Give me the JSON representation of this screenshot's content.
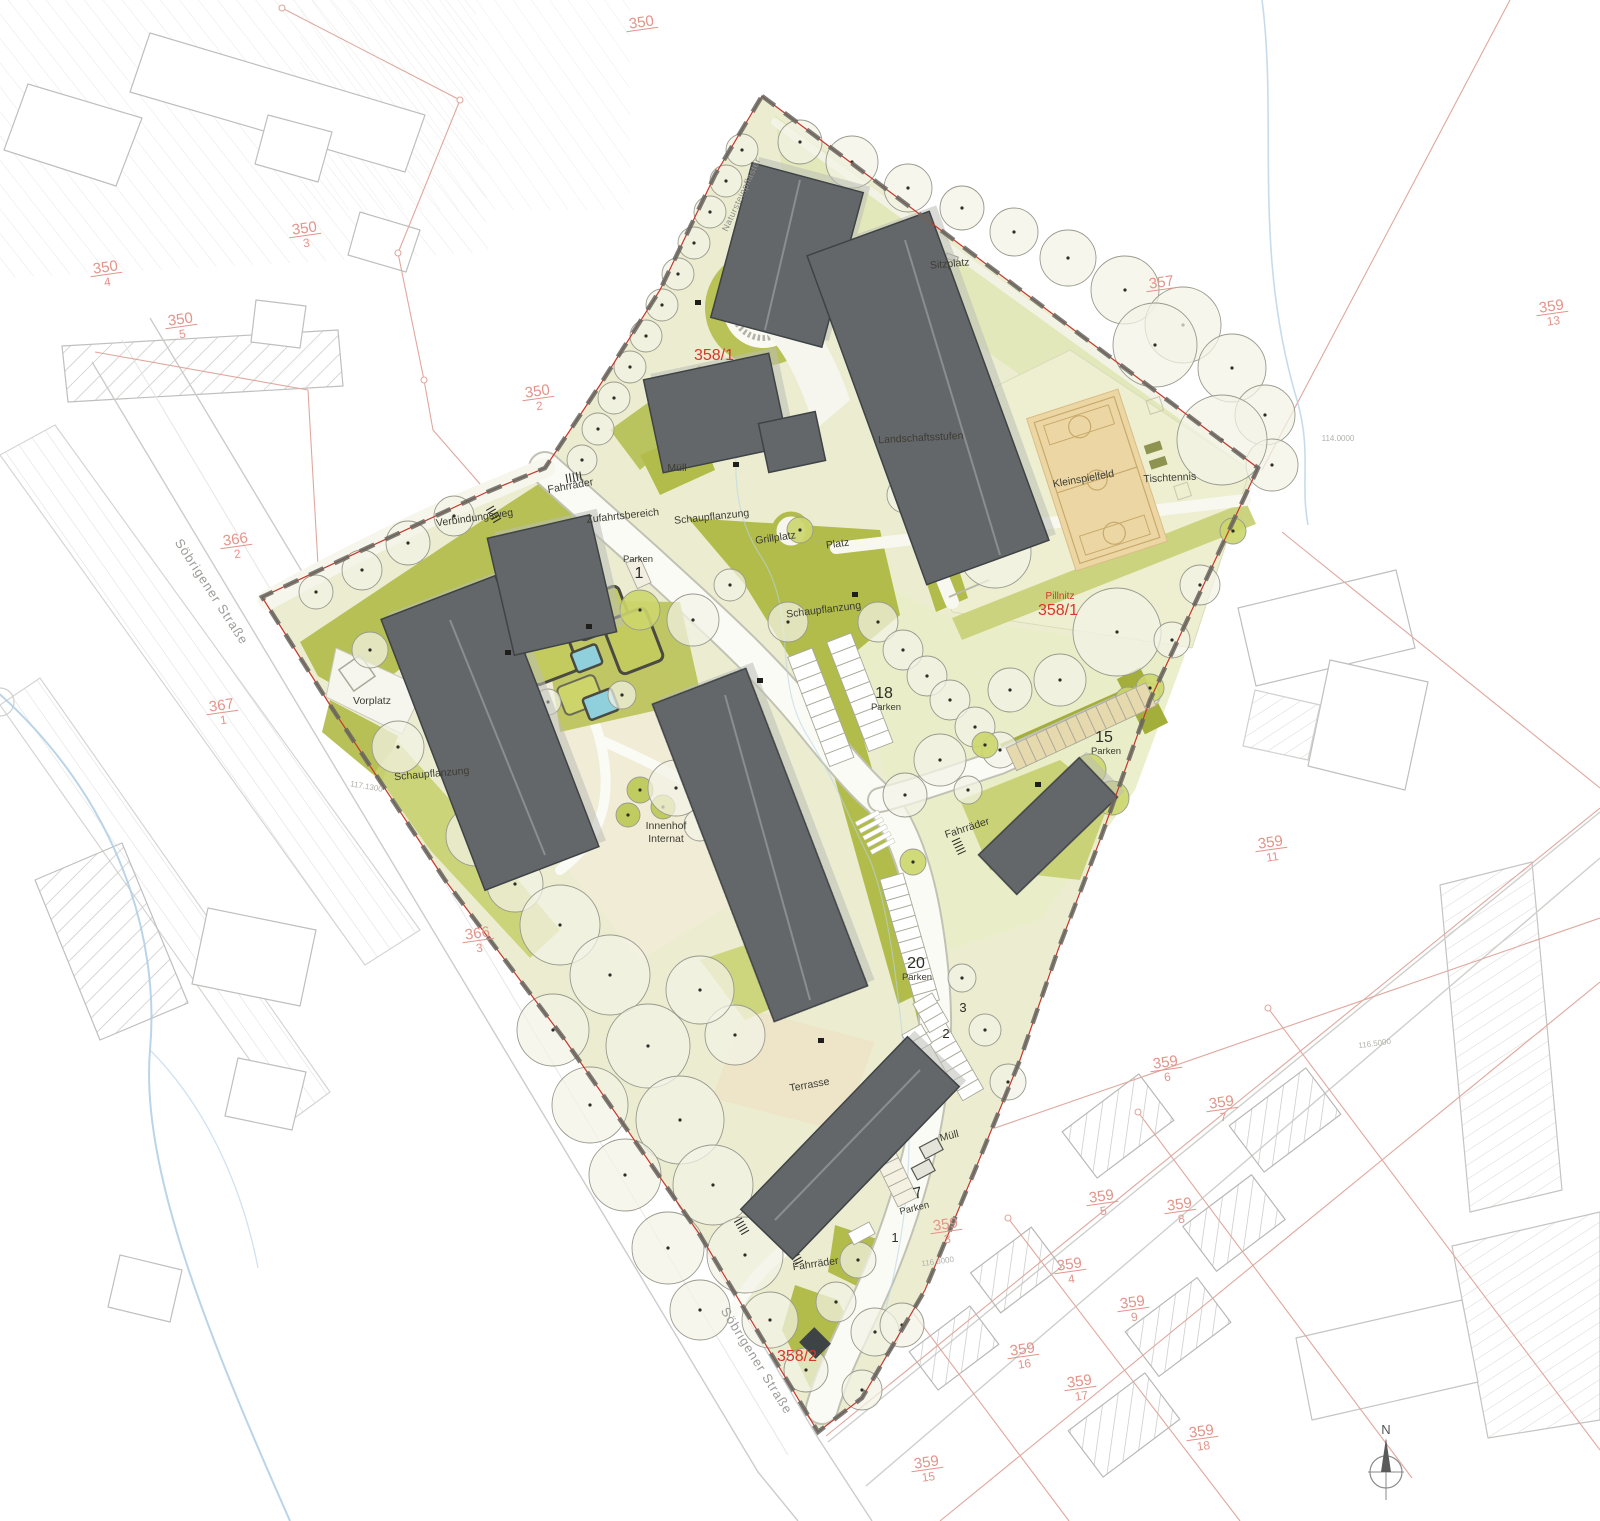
{
  "plan": {
    "type": "landscape site plan",
    "north_label": "N"
  },
  "colors": {
    "site_fill": "#ecedd0",
    "lawn": "#e9ecc6",
    "green_band": "#e3e8ba",
    "olive": "#b2bc4a",
    "olive_dark": "#a3ae3b",
    "olive_soft": "#c8d06e",
    "building": "#64676a",
    "building_dark": "#3e4346",
    "court_fill": "#ecd7a4",
    "court_line": "#c9a96c",
    "tree_fill": "#f3f3e6",
    "tree_olive": "#ccd66c",
    "road_white": "#fbfbf6",
    "boundary_gray": "#666660",
    "boundary_red": "#c4372c",
    "parcel_salmon": "#dfa89e",
    "context_gray": "#c9c9c9",
    "water_blue": "#aecde4",
    "cream": "#f0ead2"
  },
  "labels": {
    "site": [
      {
        "name": "fahrraeder-top",
        "t": "Fahrräder",
        "x": 571,
        "y": 489,
        "r": -10,
        "c": "site-label"
      },
      {
        "name": "verbindungsweg",
        "t": "Verbindungsweg",
        "x": 475,
        "y": 521,
        "r": -8,
        "c": "site-label"
      },
      {
        "name": "zufahrtsbereich",
        "t": "Zufahrtsbereich",
        "x": 623,
        "y": 519,
        "r": -6,
        "c": "site-label"
      },
      {
        "name": "muell-top",
        "t": "Müll",
        "x": 677,
        "y": 471,
        "r": 0,
        "c": "site-label"
      },
      {
        "name": "schaupflanzung-top",
        "t": "Schaupflanzung",
        "x": 712,
        "y": 520,
        "r": -6,
        "c": "site-label"
      },
      {
        "name": "grillplatz",
        "t": "Grillplatz",
        "x": 776,
        "y": 541,
        "r": -8,
        "c": "site-label"
      },
      {
        "name": "platz",
        "t": "Platz",
        "x": 838,
        "y": 547,
        "r": -8,
        "c": "site-label"
      },
      {
        "name": "landschaftsstufen",
        "t": "Landschaftsstufen",
        "x": 921,
        "y": 441,
        "r": -3,
        "c": "site-label"
      },
      {
        "name": "kleinspielfeld",
        "t": "Kleinspielfeld",
        "x": 1084,
        "y": 482,
        "r": -10,
        "c": "site-label"
      },
      {
        "name": "tischtennis",
        "t": "Tischtennis",
        "x": 1170,
        "y": 481,
        "r": -3,
        "c": "site-label"
      },
      {
        "name": "sitzplatz",
        "t": "Sitzplatz",
        "x": 950,
        "y": 267,
        "r": -5,
        "c": "site-label"
      },
      {
        "name": "schaupflanzung-mid",
        "t": "Schaupflanzung",
        "x": 824,
        "y": 613,
        "r": -7,
        "c": "site-label"
      },
      {
        "name": "vorplatz",
        "t": "Vorplatz",
        "x": 372,
        "y": 704,
        "r": 0,
        "c": "site-label"
      },
      {
        "name": "schaupflanzung-left",
        "t": "Schaupflanzung",
        "x": 432,
        "y": 777,
        "r": -5,
        "c": "site-label"
      },
      {
        "name": "innenhof-line1",
        "t": "Innenhof",
        "x": 666,
        "y": 829,
        "r": 0,
        "c": "site-label"
      },
      {
        "name": "innenhof-line2",
        "t": "Internat",
        "x": 666,
        "y": 842,
        "r": 0,
        "c": "site-label"
      },
      {
        "name": "fahrraeder-mid",
        "t": "Fahrräder",
        "x": 968,
        "y": 831,
        "r": -18,
        "c": "site-label"
      },
      {
        "name": "terrasse",
        "t": "Terrasse",
        "x": 810,
        "y": 1088,
        "r": -10,
        "c": "site-label"
      },
      {
        "name": "muell-bottom",
        "t": "Müll",
        "x": 950,
        "y": 1139,
        "r": -14,
        "c": "site-label"
      },
      {
        "name": "fahrraeder-bottom",
        "t": "Fahrräder",
        "x": 816,
        "y": 1267,
        "r": -8,
        "c": "site-label"
      },
      {
        "name": "natursteinpflaster",
        "t": "Natursteinpflaster",
        "x": 744,
        "y": 196,
        "r": -65,
        "c": "roadname-label"
      },
      {
        "name": "soebrigener-strasse-nw",
        "t": "Söbrigener Straße",
        "x": 208,
        "y": 594,
        "r": 57,
        "c": "street-label"
      },
      {
        "name": "soebrigener-strasse-s",
        "t": "Söbrigener Straße",
        "x": 753,
        "y": 1363,
        "r": 58,
        "c": "street-label"
      }
    ],
    "parking": [
      {
        "name": "parken-18",
        "num": "18",
        "word": "Parken",
        "nx": 884,
        "ny": 698,
        "wx": 886,
        "wy": 710,
        "r": 0
      },
      {
        "name": "parken-15",
        "num": "15",
        "word": "Parken",
        "nx": 1104,
        "ny": 742,
        "wx": 1106,
        "wy": 754,
        "r": 0
      },
      {
        "name": "parken-20",
        "num": "20",
        "word": "Parken",
        "nx": 916,
        "ny": 968,
        "wx": 917,
        "wy": 980,
        "r": 0
      },
      {
        "name": "parken-7",
        "num": "7",
        "word": "Parken",
        "nx": 919,
        "ny": 1198,
        "wx": 915,
        "wy": 1211,
        "r": -14
      },
      {
        "name": "parken-1-top",
        "num": "1",
        "word": "Parken",
        "nx": 639,
        "ny": 578,
        "wx": 638,
        "wy": 562,
        "r": 0
      }
    ],
    "digits": [
      {
        "name": "stall-digit-3",
        "t": "3",
        "x": 963,
        "y": 1012
      },
      {
        "name": "stall-digit-2",
        "t": "2",
        "x": 946,
        "y": 1038
      },
      {
        "name": "stall-digit-1",
        "t": "1",
        "x": 895,
        "y": 1242
      }
    ],
    "red": [
      {
        "name": "flurstueck-358-1-top",
        "t": "358/1",
        "x": 714,
        "y": 360,
        "c": "red-big"
      },
      {
        "name": "pillnitz",
        "t": "Pillnitz",
        "x": 1060,
        "y": 599,
        "c": "red-small"
      },
      {
        "name": "flurstueck-358-1-mid",
        "t": "358/1",
        "x": 1058,
        "y": 615,
        "c": "red-big"
      },
      {
        "name": "flurstueck-358-2",
        "t": "358/2",
        "x": 797,
        "y": 1361,
        "c": "red-big"
      }
    ],
    "parcels": [
      {
        "name": "parcel-350",
        "num": "350",
        "den": "",
        "x": 642,
        "y": 27
      },
      {
        "name": "parcel-350-2",
        "num": "350",
        "den": "2",
        "x": 538,
        "y": 396
      },
      {
        "name": "parcel-350-3",
        "num": "350",
        "den": "3",
        "x": 305,
        "y": 233
      },
      {
        "name": "parcel-350-4",
        "num": "350",
        "den": "4",
        "x": 106,
        "y": 272
      },
      {
        "name": "parcel-350-5",
        "num": "350",
        "den": "5",
        "x": 181,
        "y": 324
      },
      {
        "name": "parcel-366-2",
        "num": "366",
        "den": "2",
        "x": 236,
        "y": 544
      },
      {
        "name": "parcel-367-1",
        "num": "367",
        "den": "1",
        "x": 222,
        "y": 710
      },
      {
        "name": "parcel-366-3",
        "num": "366",
        "den": "3",
        "x": 478,
        "y": 938
      },
      {
        "name": "parcel-357",
        "num": "357",
        "den": "",
        "x": 1162,
        "y": 287
      },
      {
        "name": "parcel-359-13",
        "num": "359",
        "den": "13",
        "x": 1552,
        "y": 311
      },
      {
        "name": "parcel-359-11",
        "num": "359",
        "den": "11",
        "x": 1271,
        "y": 847
      },
      {
        "name": "parcel-359-6",
        "num": "359",
        "den": "6",
        "x": 1166,
        "y": 1067
      },
      {
        "name": "parcel-359-7",
        "num": "359",
        "den": "7",
        "x": 1222,
        "y": 1107
      },
      {
        "name": "parcel-359-5",
        "num": "359",
        "den": "5",
        "x": 1102,
        "y": 1201
      },
      {
        "name": "parcel-359-8",
        "num": "359",
        "den": "8",
        "x": 1180,
        "y": 1209
      },
      {
        "name": "parcel-359-4",
        "num": "359",
        "den": "4",
        "x": 1070,
        "y": 1269
      },
      {
        "name": "parcel-359-9",
        "num": "359",
        "den": "9",
        "x": 1133,
        "y": 1307
      },
      {
        "name": "parcel-359-3",
        "num": "359",
        "den": "3",
        "x": 946,
        "y": 1229
      },
      {
        "name": "parcel-359-16",
        "num": "359",
        "den": "16",
        "x": 1023,
        "y": 1354
      },
      {
        "name": "parcel-359-17",
        "num": "359",
        "den": "17",
        "x": 1080,
        "y": 1386
      },
      {
        "name": "parcel-359-18",
        "num": "359",
        "den": "18",
        "x": 1202,
        "y": 1436
      },
      {
        "name": "parcel-359-15",
        "num": "359",
        "den": "15",
        "x": 927,
        "y": 1467
      }
    ],
    "elevations": [
      {
        "name": "elev-117-1300",
        "t": "117.1300",
        "x": 366,
        "y": 789,
        "r": 10
      },
      {
        "name": "elev-114-0000",
        "t": "114.0000",
        "x": 1338,
        "y": 441,
        "r": 0
      },
      {
        "name": "elev-116-5000",
        "t": "116.5000",
        "x": 1375,
        "y": 1046,
        "r": -8
      },
      {
        "name": "elev-116-8000",
        "t": "116.8000",
        "x": 938,
        "y": 1264,
        "r": -8
      }
    ]
  }
}
